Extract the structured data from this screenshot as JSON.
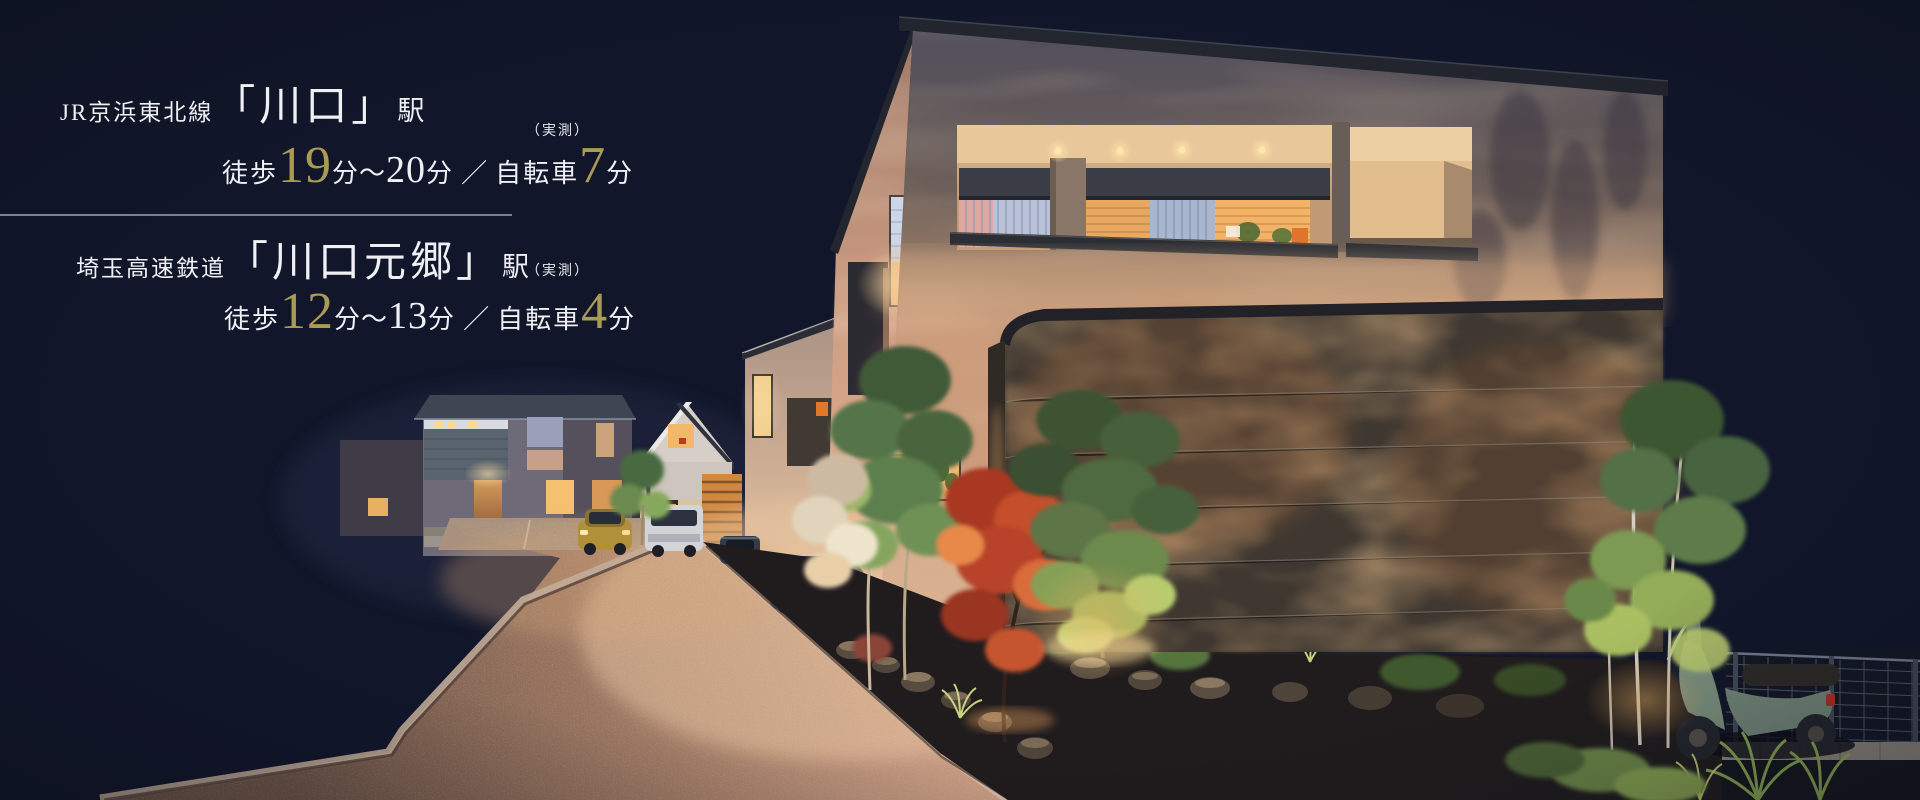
{
  "colors": {
    "background_navy": "#11162a",
    "text_white": "#eef0f4",
    "accent_gold": "#a99b55",
    "divider_gray": "#8e94a0",
    "warm_light": "#e8b87a"
  },
  "access_info": {
    "stations": [
      {
        "railway_line": "JR京浜東北線",
        "station_name": "「川口」",
        "station_suffix": "駅",
        "measurement_note": "（実測）",
        "walk_label": "徒歩",
        "walk_min_minutes": "19",
        "unit_after_min": "分",
        "range_tilde": "〜",
        "walk_max_minutes": "20",
        "unit_after_max": "分",
        "separator_slash": "／",
        "bicycle_label": "自転車",
        "bicycle_minutes": "7",
        "unit_after_bike": "分"
      },
      {
        "railway_line": "埼玉高速鉄道",
        "station_name": "「川口元郷」",
        "station_suffix": "駅",
        "measurement_note": "（実測）",
        "walk_label": "徒歩",
        "walk_min_minutes": "12",
        "unit_after_min": "分",
        "range_tilde": "〜",
        "walk_max_minutes": "13",
        "unit_after_max": "分",
        "separator_slash": "／",
        "bicycle_label": "自転車",
        "bicycle_minutes": "4",
        "unit_after_bike": "分"
      }
    ]
  }
}
